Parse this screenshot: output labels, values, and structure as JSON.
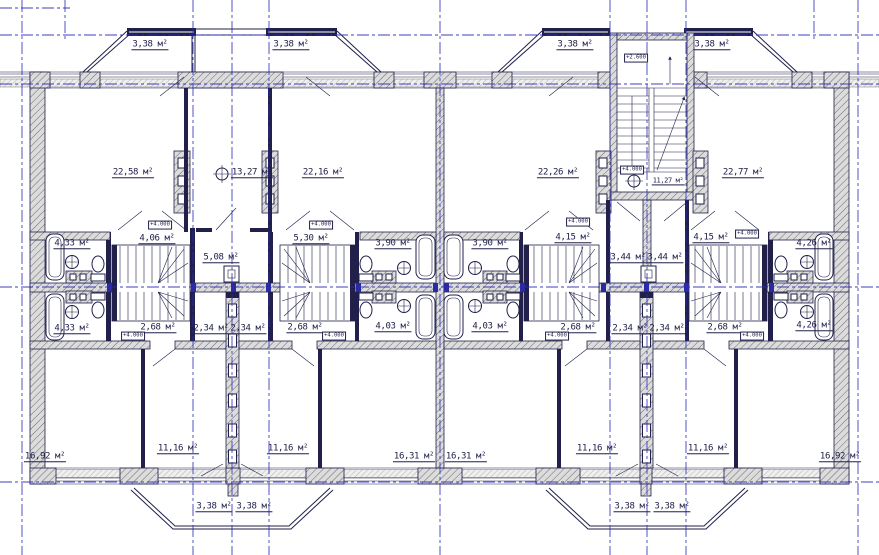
{
  "drawing": {
    "area_unit": "м²",
    "colors": {
      "grid_axis": "#2a2ab8",
      "line": "#20204a",
      "wall_fill": "#dcdcdc",
      "accent": "#2a2aa8"
    }
  },
  "labels": {
    "areas": [
      {
        "text": "3,38 м²",
        "x": 150,
        "y": 46
      },
      {
        "text": "3,38 м²",
        "x": 291,
        "y": 46
      },
      {
        "text": "3,38 м²",
        "x": 575,
        "y": 46
      },
      {
        "text": "3,38 м²",
        "x": 712,
        "y": 46
      },
      {
        "text": "22,58 м²",
        "x": 133,
        "y": 174
      },
      {
        "text": "13,27 м²",
        "x": 252,
        "y": 174
      },
      {
        "text": "22,16 м²",
        "x": 323,
        "y": 174
      },
      {
        "text": "22,26 м²",
        "x": 558,
        "y": 174
      },
      {
        "text": "11,27 м²",
        "x": 668,
        "y": 182,
        "small": true
      },
      {
        "text": "22,77 м²",
        "x": 743,
        "y": 174
      },
      {
        "text": "4,33 м²",
        "x": 72,
        "y": 245
      },
      {
        "text": "4,06 м²",
        "x": 157,
        "y": 240
      },
      {
        "text": "5,08 м²",
        "x": 221,
        "y": 259
      },
      {
        "text": "5,30 м²",
        "x": 311,
        "y": 240
      },
      {
        "text": "3,90 м²",
        "x": 393,
        "y": 245
      },
      {
        "text": "3,90 м²",
        "x": 490,
        "y": 245
      },
      {
        "text": "4,15 м²",
        "x": 573,
        "y": 239
      },
      {
        "text": "3,44 м²",
        "x": 628,
        "y": 259
      },
      {
        "text": "3,44 м²",
        "x": 665,
        "y": 259
      },
      {
        "text": "4,15 м²",
        "x": 711,
        "y": 239
      },
      {
        "text": "4,26 м²",
        "x": 814,
        "y": 245
      },
      {
        "text": "4,33 м²",
        "x": 72,
        "y": 330
      },
      {
        "text": "2,68 м²",
        "x": 158,
        "y": 329
      },
      {
        "text": "2,34 м²",
        "x": 211,
        "y": 330
      },
      {
        "text": "2,34 м²",
        "x": 248,
        "y": 330
      },
      {
        "text": "2,68 м²",
        "x": 305,
        "y": 329
      },
      {
        "text": "4,03 м²",
        "x": 393,
        "y": 328
      },
      {
        "text": "4,03 м²",
        "x": 490,
        "y": 328
      },
      {
        "text": "2,68 м²",
        "x": 578,
        "y": 329
      },
      {
        "text": "2,34 м²",
        "x": 630,
        "y": 330
      },
      {
        "text": "2,34 м²",
        "x": 667,
        "y": 330
      },
      {
        "text": "2,68 м²",
        "x": 725,
        "y": 329
      },
      {
        "text": "4,26 м²",
        "x": 814,
        "y": 327
      },
      {
        "text": "16,92 м²",
        "x": 45,
        "y": 458
      },
      {
        "text": "11,16 м²",
        "x": 178,
        "y": 450
      },
      {
        "text": "11,16 м²",
        "x": 288,
        "y": 450
      },
      {
        "text": "16,31 м²",
        "x": 414,
        "y": 458
      },
      {
        "text": "16,31 м²",
        "x": 466,
        "y": 458
      },
      {
        "text": "11,16 м²",
        "x": 597,
        "y": 450
      },
      {
        "text": "11,16 м²",
        "x": 708,
        "y": 450
      },
      {
        "text": "16,92 м²",
        "x": 840,
        "y": 458
      },
      {
        "text": "3,38 м²",
        "x": 214,
        "y": 508
      },
      {
        "text": "3,38 м²",
        "x": 254,
        "y": 508
      },
      {
        "text": "3,38 м²",
        "x": 632,
        "y": 508
      },
      {
        "text": "3,38 м²",
        "x": 672,
        "y": 508
      }
    ],
    "elevations": [
      {
        "text": "+2.600",
        "x": 636,
        "y": 58
      },
      {
        "text": "+4.000",
        "x": 632,
        "y": 170
      },
      {
        "text": "+4.000",
        "x": 160,
        "y": 225
      },
      {
        "text": "+4.000",
        "x": 321,
        "y": 225
      },
      {
        "text": "+4.000",
        "x": 578,
        "y": 222
      },
      {
        "text": "+4.000",
        "x": 747,
        "y": 234
      },
      {
        "text": "+4.000",
        "x": 133,
        "y": 336
      },
      {
        "text": "+4.000",
        "x": 334,
        "y": 336
      },
      {
        "text": "+4.000",
        "x": 557,
        "y": 336
      },
      {
        "text": "+4.000",
        "x": 752,
        "y": 336
      }
    ]
  }
}
